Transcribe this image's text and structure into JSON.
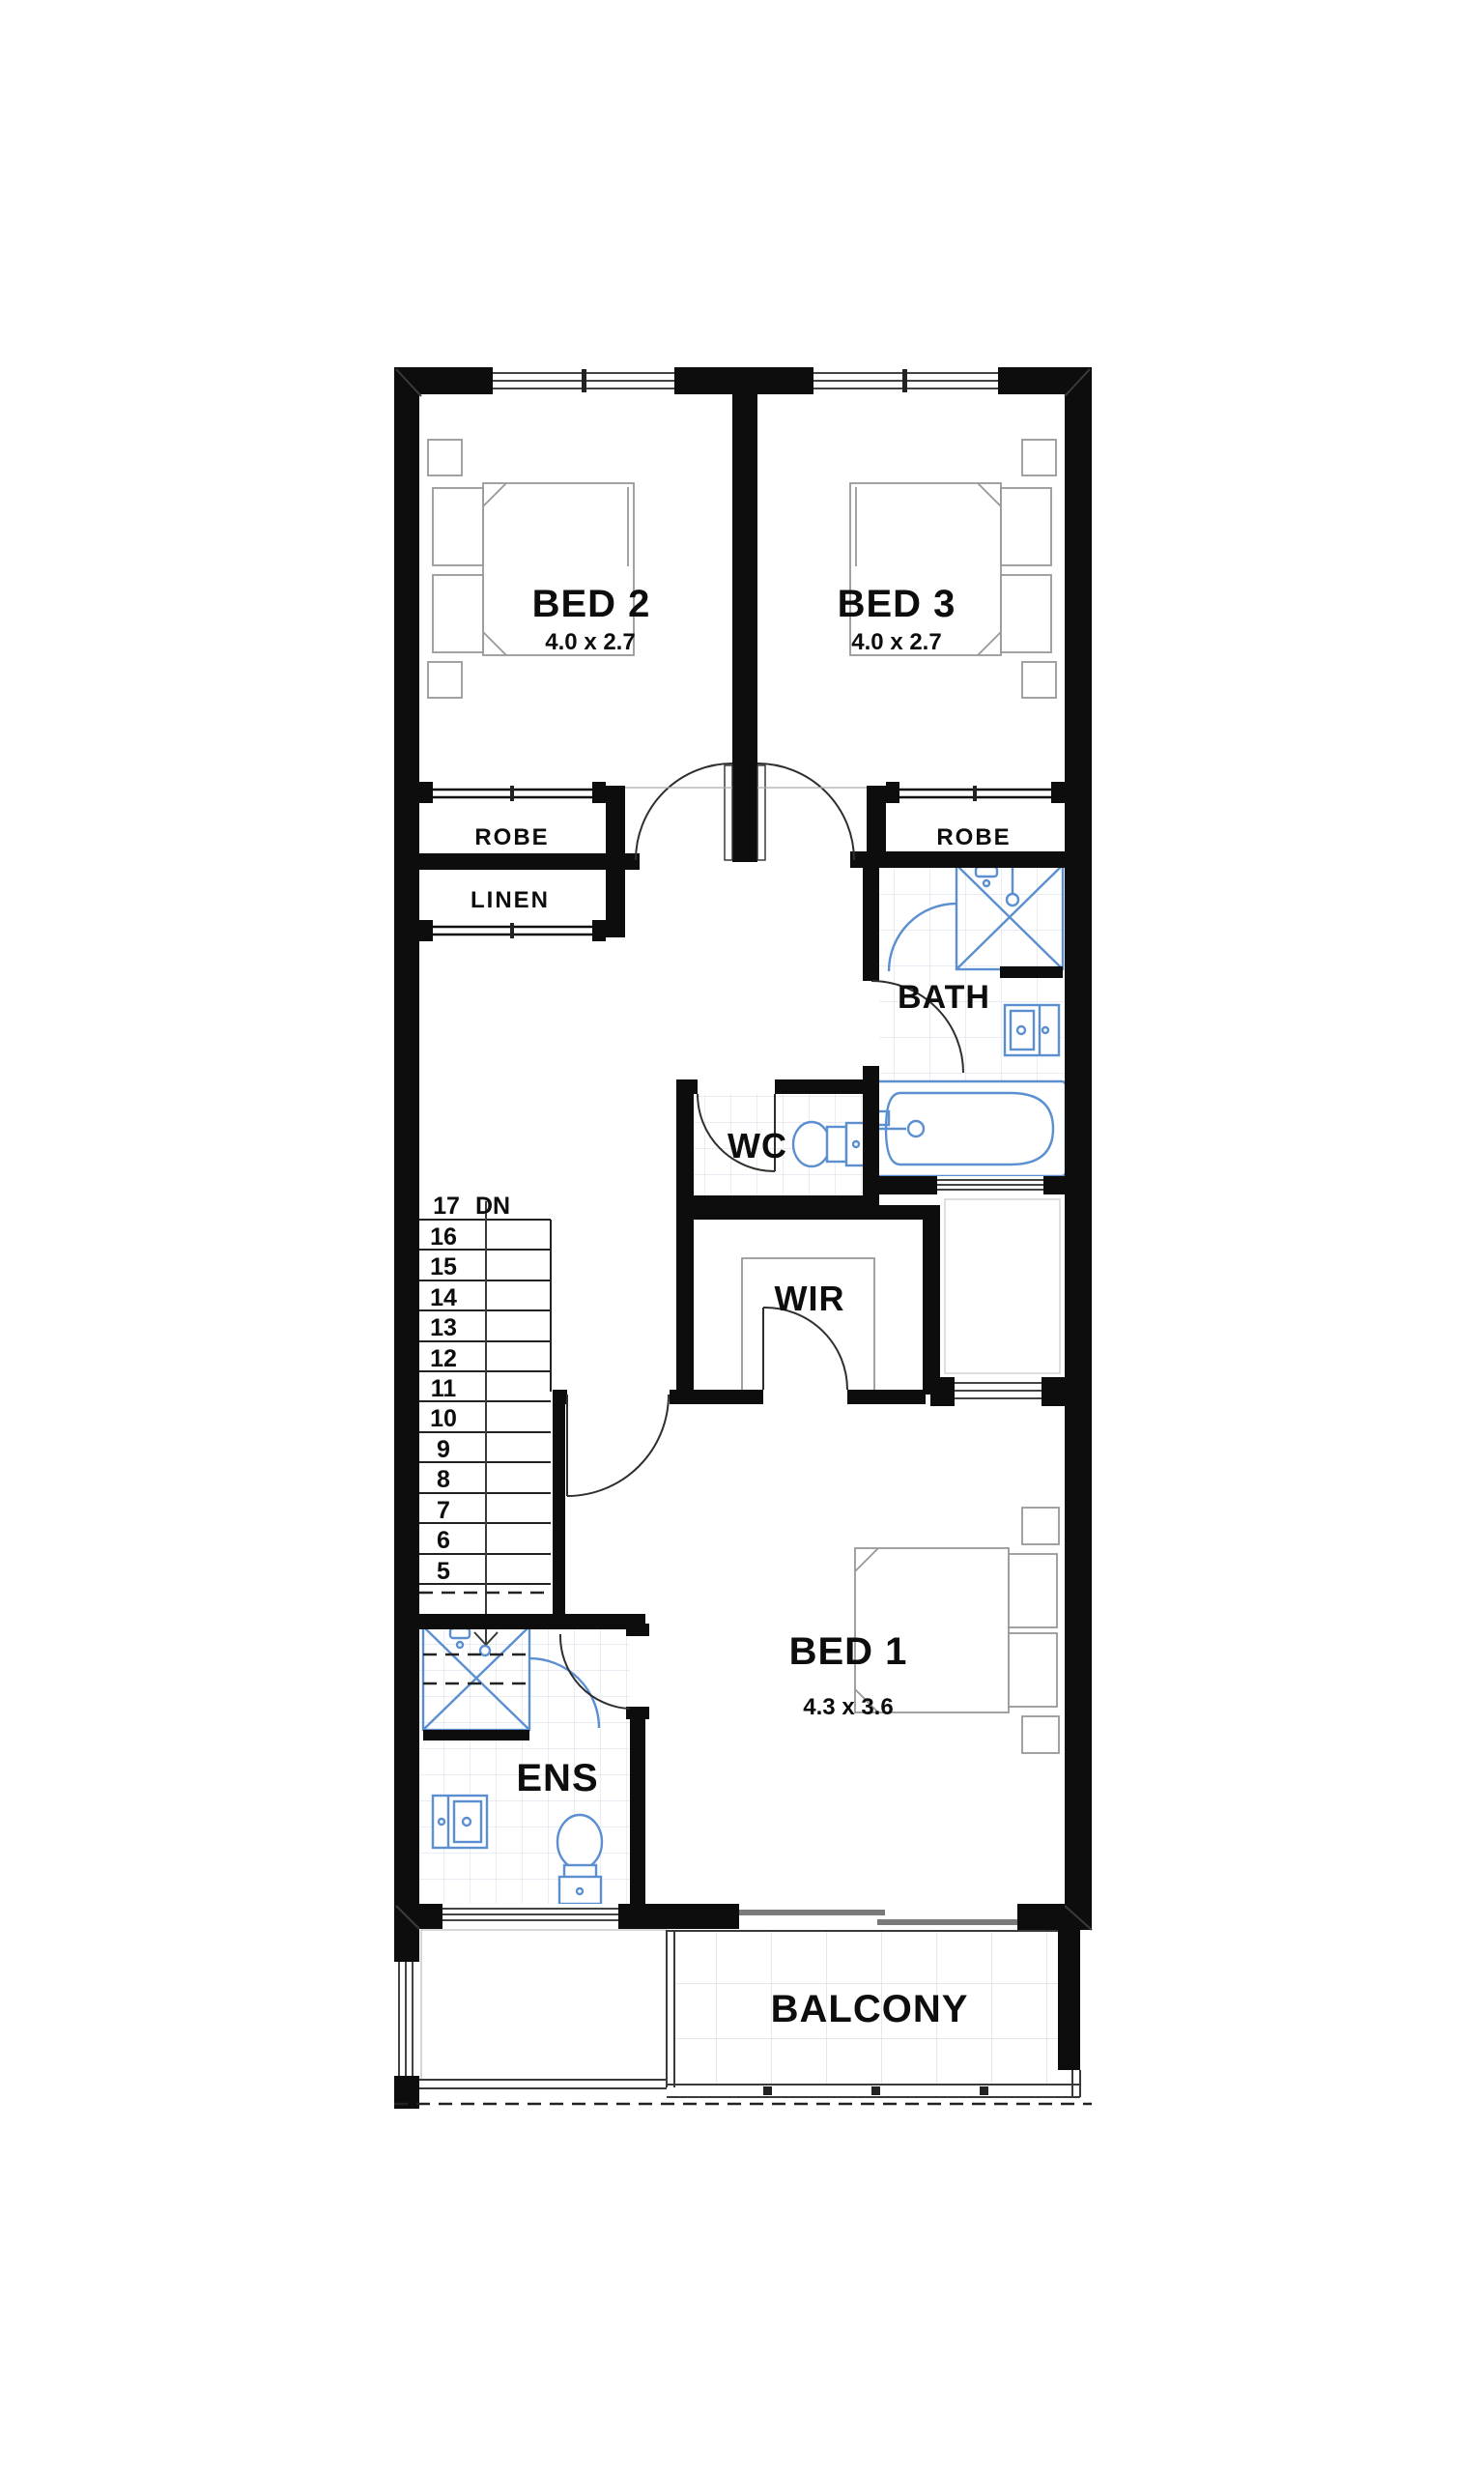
{
  "rooms": {
    "bed2": {
      "label": "BED 2",
      "dims": "4.0 x 2.7"
    },
    "bed3": {
      "label": "BED 3",
      "dims": "4.0 x 2.7"
    },
    "bed1": {
      "label": "BED 1",
      "dims": "4.3 x 3.6"
    },
    "robe_left": {
      "label": "ROBE"
    },
    "robe_right": {
      "label": "ROBE"
    },
    "linen": {
      "label": "LINEN"
    },
    "bath": {
      "label": "BATH"
    },
    "wc": {
      "label": "WC"
    },
    "wir": {
      "label": "WIR"
    },
    "ens": {
      "label": "ENS"
    },
    "balcony": {
      "label": "BALCONY"
    }
  },
  "stairs": {
    "top_number": "17",
    "direction": "DN",
    "treads": [
      "16",
      "15",
      "14",
      "13",
      "12",
      "11",
      "10",
      "9",
      "8",
      "7",
      "6",
      "5"
    ]
  },
  "colors": {
    "wall": "#0d0d0d",
    "fixture_blue": "#5b8fd0",
    "furniture_gray": "#98989b",
    "tile_line": "#dce1ea"
  }
}
